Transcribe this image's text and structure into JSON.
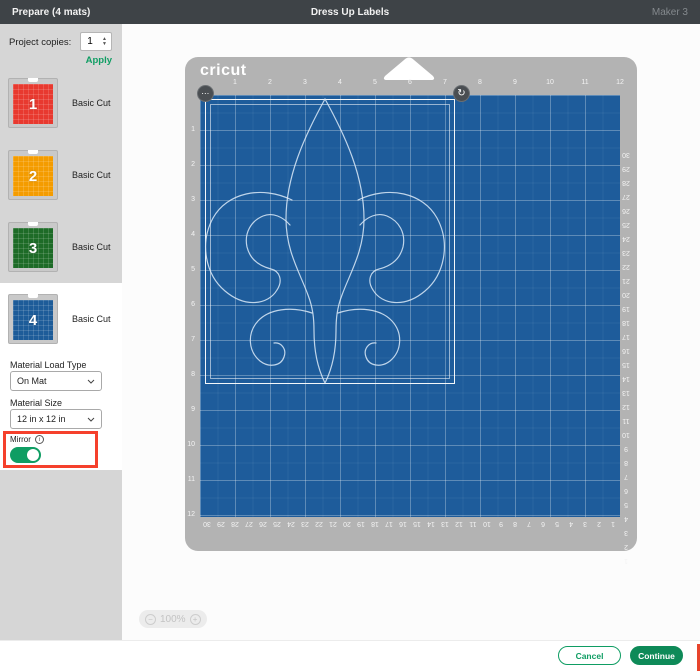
{
  "topbar": {
    "left": "Prepare (4 mats)",
    "title": "Dress Up Labels",
    "right": "Maker 3"
  },
  "sidebar": {
    "project_copies_label": "Project copies:",
    "project_copies_value": "1",
    "apply_label": "Apply",
    "mats": [
      {
        "number": "1",
        "type": "Basic Cut",
        "color": "#e8392f",
        "selected": false
      },
      {
        "number": "2",
        "type": "Basic Cut",
        "color": "#f49c00",
        "selected": false
      },
      {
        "number": "3",
        "type": "Basic Cut",
        "color": "#1d6b27",
        "selected": false
      },
      {
        "number": "4",
        "type": "Basic Cut",
        "color": "#1d5c99",
        "selected": true
      }
    ],
    "material_load_type": {
      "label": "Material Load Type",
      "value": "On Mat"
    },
    "material_size": {
      "label": "Material Size",
      "value": "12 in x 12 in"
    },
    "mirror": {
      "label": "Mirror",
      "enabled": true
    }
  },
  "mat_preview": {
    "brand": "cricut",
    "shape": "fleur-de-lis outline",
    "ruler_top": [
      1,
      2,
      3,
      4,
      5,
      6,
      7,
      8,
      9,
      10,
      11,
      12
    ],
    "ruler_left": [
      1,
      2,
      3,
      4,
      5,
      6,
      7,
      8,
      9,
      10,
      11,
      12
    ],
    "ruler_right": [
      30,
      29,
      28,
      27,
      26,
      25,
      24,
      23,
      22,
      21,
      20,
      19,
      18,
      17,
      16,
      15,
      14,
      13,
      12,
      11,
      10,
      9,
      8,
      7,
      6,
      5,
      4,
      3,
      2,
      1
    ],
    "ruler_bottom": [
      30,
      29,
      28,
      27,
      26,
      25,
      24,
      23,
      22,
      21,
      20,
      19,
      18,
      17,
      16,
      15,
      14,
      13,
      12,
      11,
      10,
      9,
      8,
      7,
      6,
      5,
      4,
      3,
      2,
      1
    ]
  },
  "zoom_control": {
    "value": "100%"
  },
  "footer": {
    "cancel": "Cancel",
    "continue": "Continue"
  },
  "icons": {
    "minus": "−",
    "plus": "+",
    "ellipsis": "⋯",
    "rotate": "↻",
    "info": "i",
    "stepper_up": "▲",
    "stepper_down": "▼"
  },
  "colors": {
    "accent_green": "#0f9d63",
    "material_blue": "#1e5c9b",
    "mat_gray": "#b3b3b3",
    "annotation_red": "#f5402c",
    "topbar": "#3e4347"
  }
}
